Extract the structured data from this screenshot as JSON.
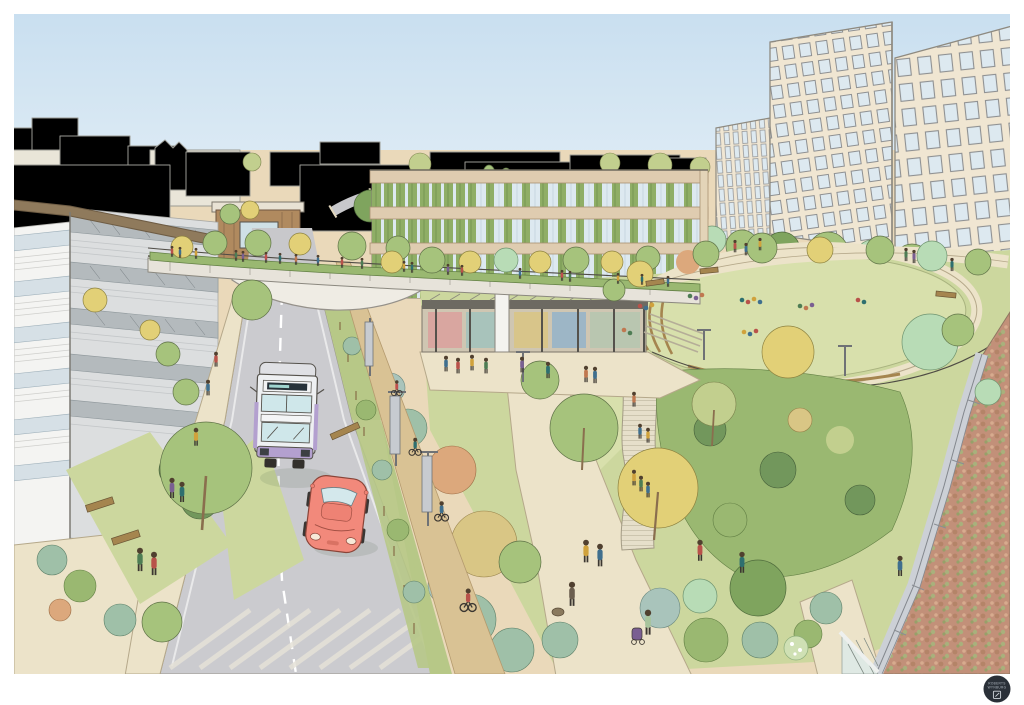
{
  "illustration": {
    "kind": "hand-drawn architectural landscape visualisation",
    "logo": {
      "line1": "ROBERTS",
      "line2": "WYNBURG"
    }
  },
  "palette": {
    "paper": "#ffffff",
    "sky_top": "#c9dff0",
    "sky_bottom": "#eef5f8",
    "ground": "#ead9ba",
    "horizon": "#efe8d8",
    "path": "#ece3c9",
    "path_edge": "#b5a88a",
    "road": "#cbcbcf",
    "road_bg": "#c8c8cb",
    "road_line": "#ffffff",
    "cycle": "#d9c294",
    "lawn": "#ccd79e",
    "lawn_light": "#d8e0ac",
    "lawn_dark": "#b7c887",
    "shrub_green": "#9ab871",
    "shrub_dark": "#72975c",
    "shrub_teal": "#9fc0a8",
    "shrub_blue": "#a9c4bb",
    "shrub_autumn": "#dca87c",
    "shrub_gold": "#d9c685",
    "tree_green": "#a6c37c",
    "tree_yellow": "#e2d077",
    "tree_mint": "#b8dcb6",
    "tree_dark": "#7fa45e",
    "tree_olive": "#c2cf8e",
    "trunk": "#8a6e4e",
    "bldg_cream": "#f0e6d2",
    "bldg_band": "#dfccb0",
    "window_glass": "#dde9f0",
    "window_frame": "#8e9092",
    "louver_green": "#8fae66",
    "left_band": "#f4f4f2",
    "left_glass": "#d6e0e6",
    "left_side_glass": "#b4babd",
    "left_side_band": "#dcdedf",
    "roof_brown": "#8f7a5c",
    "timber": "#b08a5f",
    "bridge_deck": "#e7e3da",
    "bridge_soffit": "#efece4",
    "bus_body": "#eef0f2",
    "bus_purple": "#b3a0cf",
    "bus_glass": "#cfe7ea",
    "car_body": "#f2897b",
    "car_glass": "#d4e8ec",
    "sedum": "#c29079",
    "parapet": "#ccd0d6",
    "logo_bg": "#2a3038"
  }
}
